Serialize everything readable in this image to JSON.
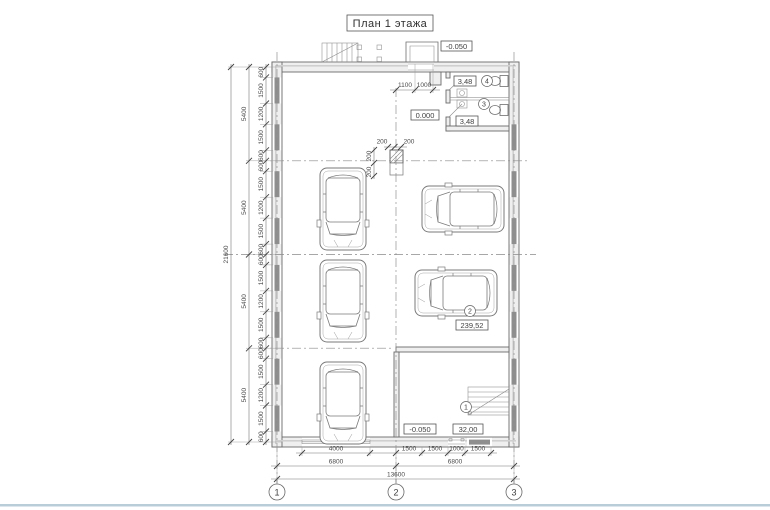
{
  "title": "План 1 этажа",
  "axes": [
    "1",
    "2",
    "3"
  ],
  "rooms": [
    {
      "num": "1",
      "area": "32,00"
    },
    {
      "num": "2",
      "area": "239,52"
    },
    {
      "num": "3",
      "area": "3,48"
    },
    {
      "num": "4",
      "area": "3,48"
    }
  ],
  "elevations": {
    "porch": "-0.050",
    "entry": "0.000",
    "room1": "-0.050"
  },
  "dims": {
    "left_total": "21600",
    "left_bays": [
      "5400",
      "5400",
      "5400",
      "5400"
    ],
    "win_left": [
      "600",
      "1500",
      "1200",
      "1500",
      "600",
      "600",
      "1500",
      "1200",
      "1500",
      "600",
      "600",
      "1500",
      "1200",
      "1500",
      "600",
      "600",
      "1500",
      "1200",
      "1500",
      "600"
    ],
    "bottom_row1": [
      "4000",
      "1500",
      "1500",
      "1000",
      "1500"
    ],
    "bottom_row2": [
      "6800",
      "6800"
    ],
    "bottom_total": "13600",
    "top_entry": [
      "1100",
      "1000"
    ],
    "column_h": [
      "200",
      "200"
    ],
    "column_v": [
      "200",
      "200"
    ]
  }
}
